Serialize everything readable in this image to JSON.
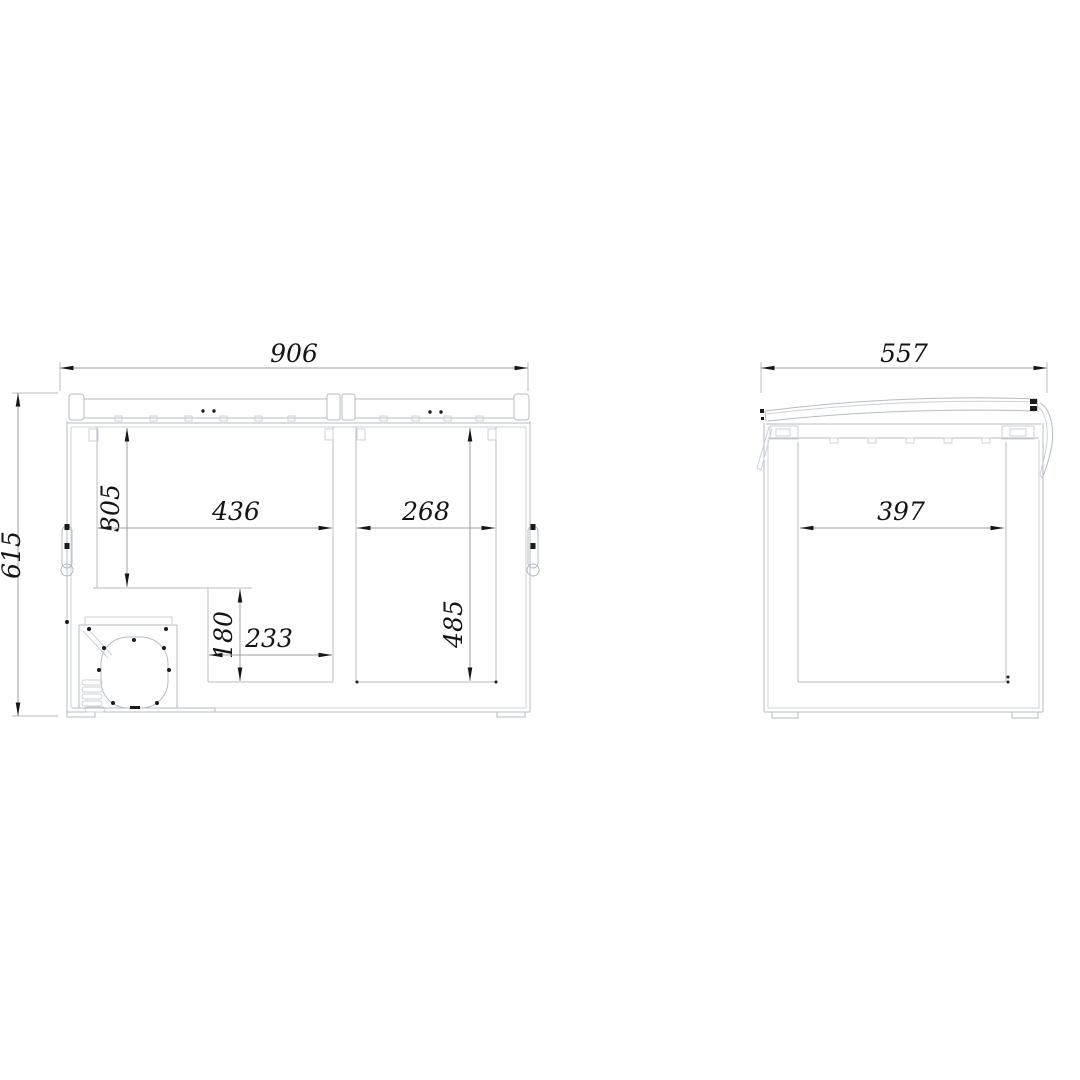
{
  "drawing": {
    "background": "#ffffff",
    "object_line_color": "#b6bcc2",
    "dimension_line_color": "#9aa0a6",
    "text_color": "#141414",
    "views": {
      "front": {
        "label": "front-section-view",
        "dimensions": {
          "overall_width": "906",
          "overall_height": "615",
          "left_compartment_depth": "305",
          "left_compartment_width": "436",
          "right_compartment_width": "268",
          "step_height": "180",
          "step_width": "233",
          "right_compartment_depth": "485"
        }
      },
      "side": {
        "label": "side-section-view",
        "dimensions": {
          "overall_depth": "557",
          "inner_depth": "397"
        }
      }
    }
  }
}
